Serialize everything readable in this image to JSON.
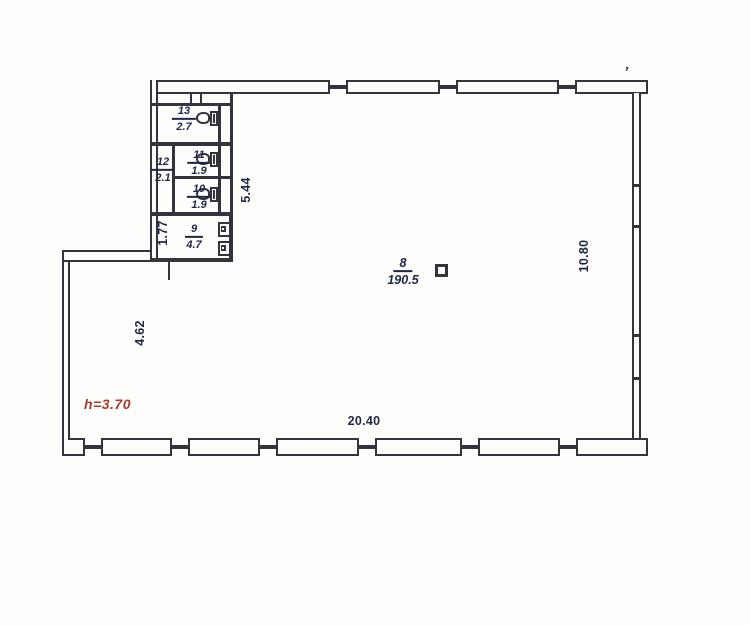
{
  "rooms": [
    {
      "num": "13",
      "area": "2.7"
    },
    {
      "num": "11",
      "area": "1.9"
    },
    {
      "num": "12",
      "area": "2.1"
    },
    {
      "num": "10",
      "area": "1.9"
    },
    {
      "num": "9",
      "area": "4.7"
    },
    {
      "num": "8",
      "area": "190.5"
    }
  ],
  "dimensions": {
    "bottom": "20.40",
    "right": "10.80",
    "left": "4.62",
    "entry": "1.77",
    "block": "5.44"
  },
  "annotations": {
    "height": "h=3.70",
    "tick": "’"
  },
  "colors": {
    "line": "#33343d",
    "label": "#1e2746",
    "red": "#ab3a2c"
  }
}
